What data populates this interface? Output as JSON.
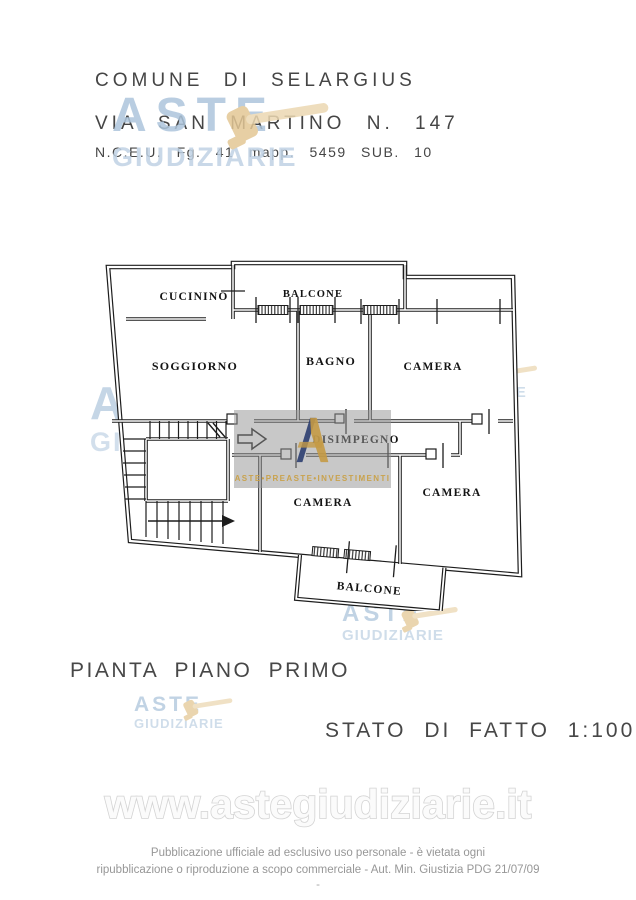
{
  "header": {
    "municipality": "COMUNE DI SELARGIUS",
    "address": "VIA SAN MARTINO N. 147",
    "cadastral": "N.C.E.U. Fg. 41 mapp. 5459 SUB. 10"
  },
  "floor_plan": {
    "rooms": {
      "cucinino": "CUCININO",
      "balcone_top": "BALCONE",
      "soggiorno": "SOGGIORNO",
      "bagno": "BAGNO",
      "camera_top_right": "CAMERA",
      "disimpegno": "DISIMPEGNO",
      "camera_center": "CAMERA",
      "camera_bottom_right": "CAMERA",
      "balcone_bottom": "BALCONE"
    },
    "line_color": "#1d1d1d"
  },
  "captions": {
    "plan_title": "PIANTA PIANO PRIMO",
    "scale_note": "STATO DI FATTO 1:100"
  },
  "watermark": {
    "line1": "ASTE",
    "line2": "GIUDIZIARIE",
    "text_color": "#b5c9de",
    "gavel_color": "#e8d2ab"
  },
  "agency_overlay": {
    "text": "ASTE•PREASTE•INVESTIMENTI",
    "text_color": "#c9a24d",
    "box_color": "#969696"
  },
  "footer": {
    "url": "www.astegiudiziarie.it",
    "line1": "Pubblicazione ufficiale ad esclusivo uso personale - è vietata ogni",
    "line2": "ripubblicazione o riproduzione a scopo commerciale - Aut. Min. Giustizia PDG 21/07/09",
    "dash": "-"
  }
}
